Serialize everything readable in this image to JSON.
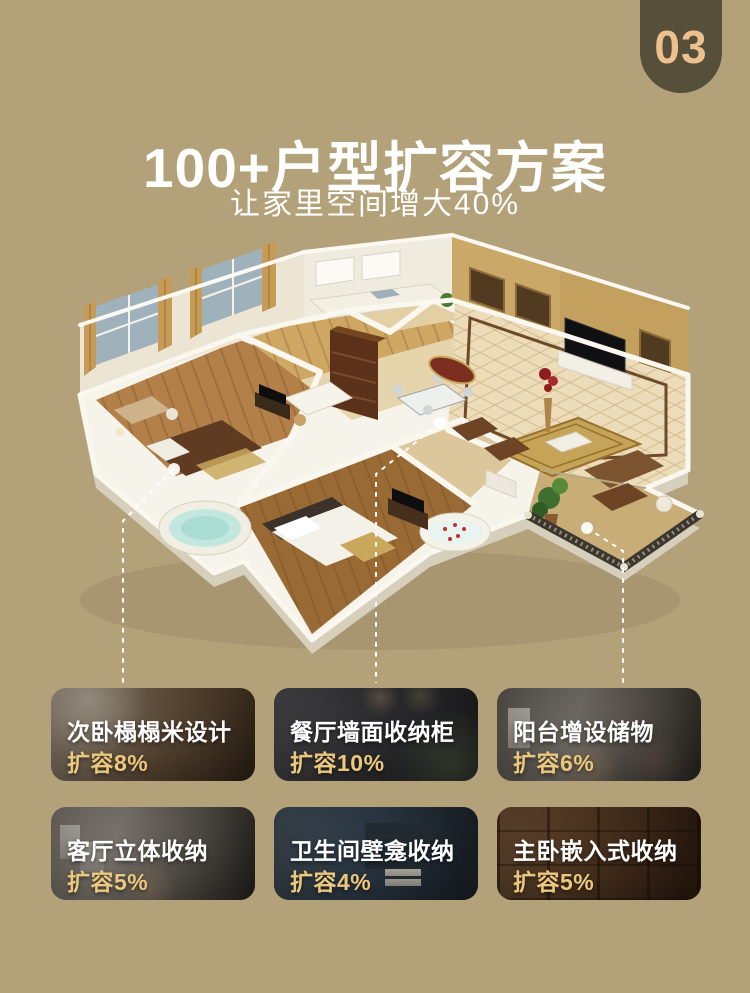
{
  "page": {
    "colors": {
      "background": "#b3a17a",
      "badge_background": "#56503a",
      "badge_text": "#eec08d",
      "title_text": "#ffffff",
      "accent_gold": "#ecc87e"
    },
    "badge": {
      "number": "03"
    },
    "header": {
      "title": "100+户型扩容方案",
      "subtitle": "让家里空间增大40%"
    },
    "cards": [
      {
        "title": "次卧榻榻米设计",
        "value": "扩容8%"
      },
      {
        "title": "餐厅墙面收纳柜",
        "value": "扩容10%"
      },
      {
        "title": "阳台增设储物",
        "value": "扩容6%"
      },
      {
        "title": "客厅立体收纳",
        "value": "扩容5%"
      },
      {
        "title": "卫生间壁龛收纳",
        "value": "扩容4%"
      },
      {
        "title": "主卧嵌入式收纳",
        "value": "扩容5%"
      }
    ]
  }
}
